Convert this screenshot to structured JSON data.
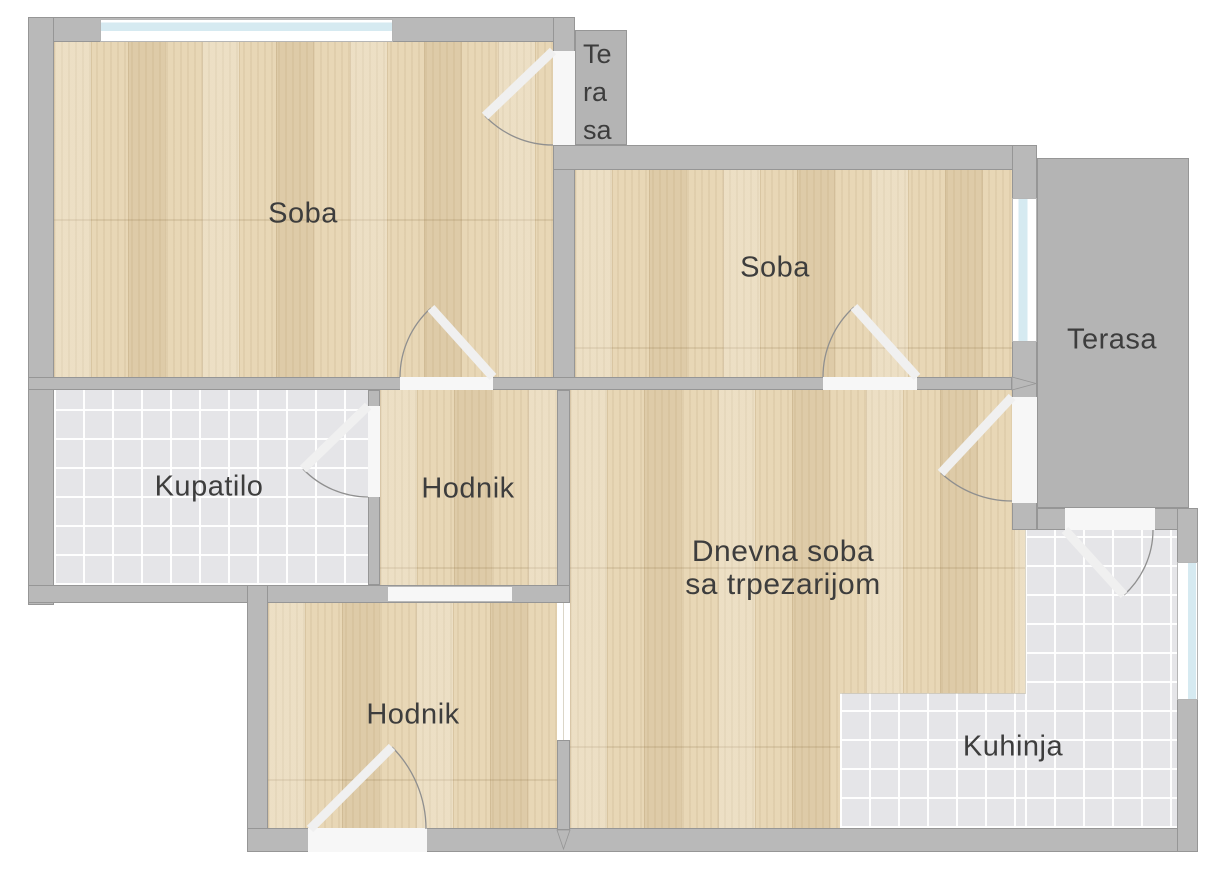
{
  "colors": {
    "wall": "#b9b9b9",
    "wall_edge": "#969696",
    "wood": "#e8d7b6",
    "tile": "#e5e5e8",
    "window_glass": "#d6eaf1",
    "label": "#3d3d3d",
    "door_leaf": "#f0f0f0",
    "door_arc": "#8f8f8f",
    "slab": "#b4b4b4"
  },
  "rooms": {
    "soba_left": {
      "label": "Soba"
    },
    "soba_right": {
      "label": "Soba"
    },
    "terasa_small": {
      "line1": "Te",
      "line2": "ra",
      "line3": "sa"
    },
    "terasa": {
      "label": "Terasa"
    },
    "kupatilo": {
      "label": "Kupatilo"
    },
    "hodnik_middle": {
      "label": "Hodnik"
    },
    "hodnik_bottom": {
      "label": "Hodnik"
    },
    "dnevna_soba": {
      "line1": "Dnevna soba",
      "line2": "sa trpezarijom"
    },
    "kuhinja": {
      "label": "Kuhinja"
    }
  }
}
